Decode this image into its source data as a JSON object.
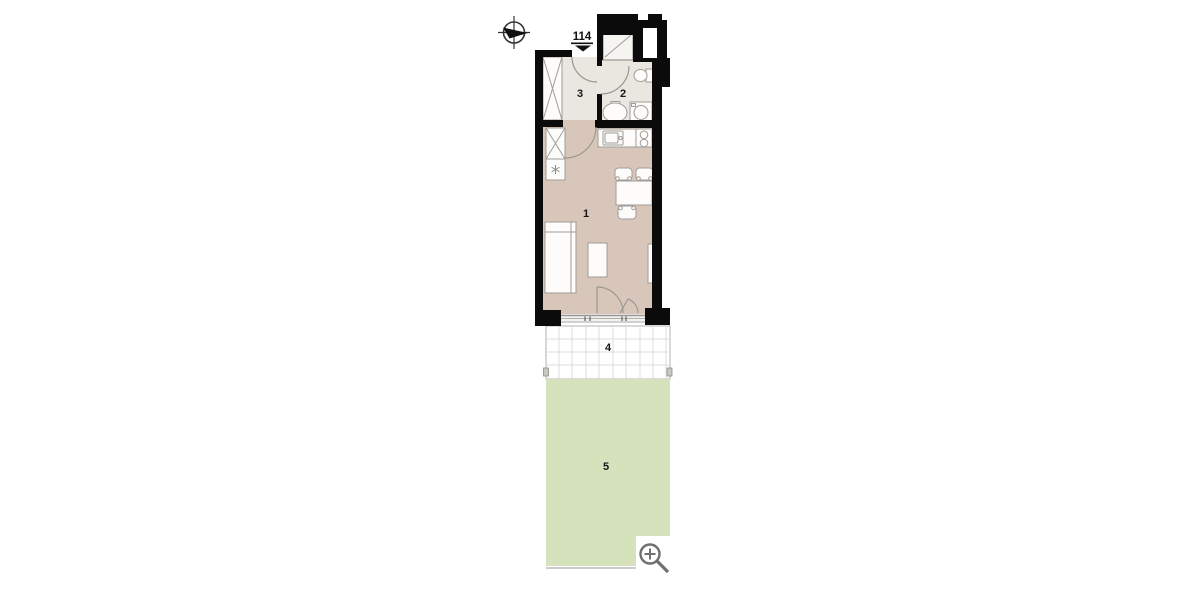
{
  "floor_plan": {
    "unit_number": "114",
    "rooms": [
      {
        "id": "room-1",
        "label": "1",
        "type": "main-room"
      },
      {
        "id": "room-2",
        "label": "2",
        "type": "bathroom"
      },
      {
        "id": "room-3",
        "label": "3",
        "type": "entrance-hall"
      },
      {
        "id": "room-4",
        "label": "4",
        "type": "terrace"
      },
      {
        "id": "room-5",
        "label": "5",
        "type": "garden"
      }
    ],
    "colors": {
      "wall": "#0b0b0b",
      "room_main_floor": "#d9c6ba",
      "room_wet_floor": "#eae6e0",
      "terrace": "#ffffff",
      "terrace_grid": "#dcdcdc",
      "garden": "#d6e2bc",
      "furniture_stroke": "#a09d98",
      "icon_gray": "#6f6f6f"
    },
    "icons": [
      "compass-icon",
      "entrance-marker-icon",
      "zoom-in-icon"
    ]
  }
}
